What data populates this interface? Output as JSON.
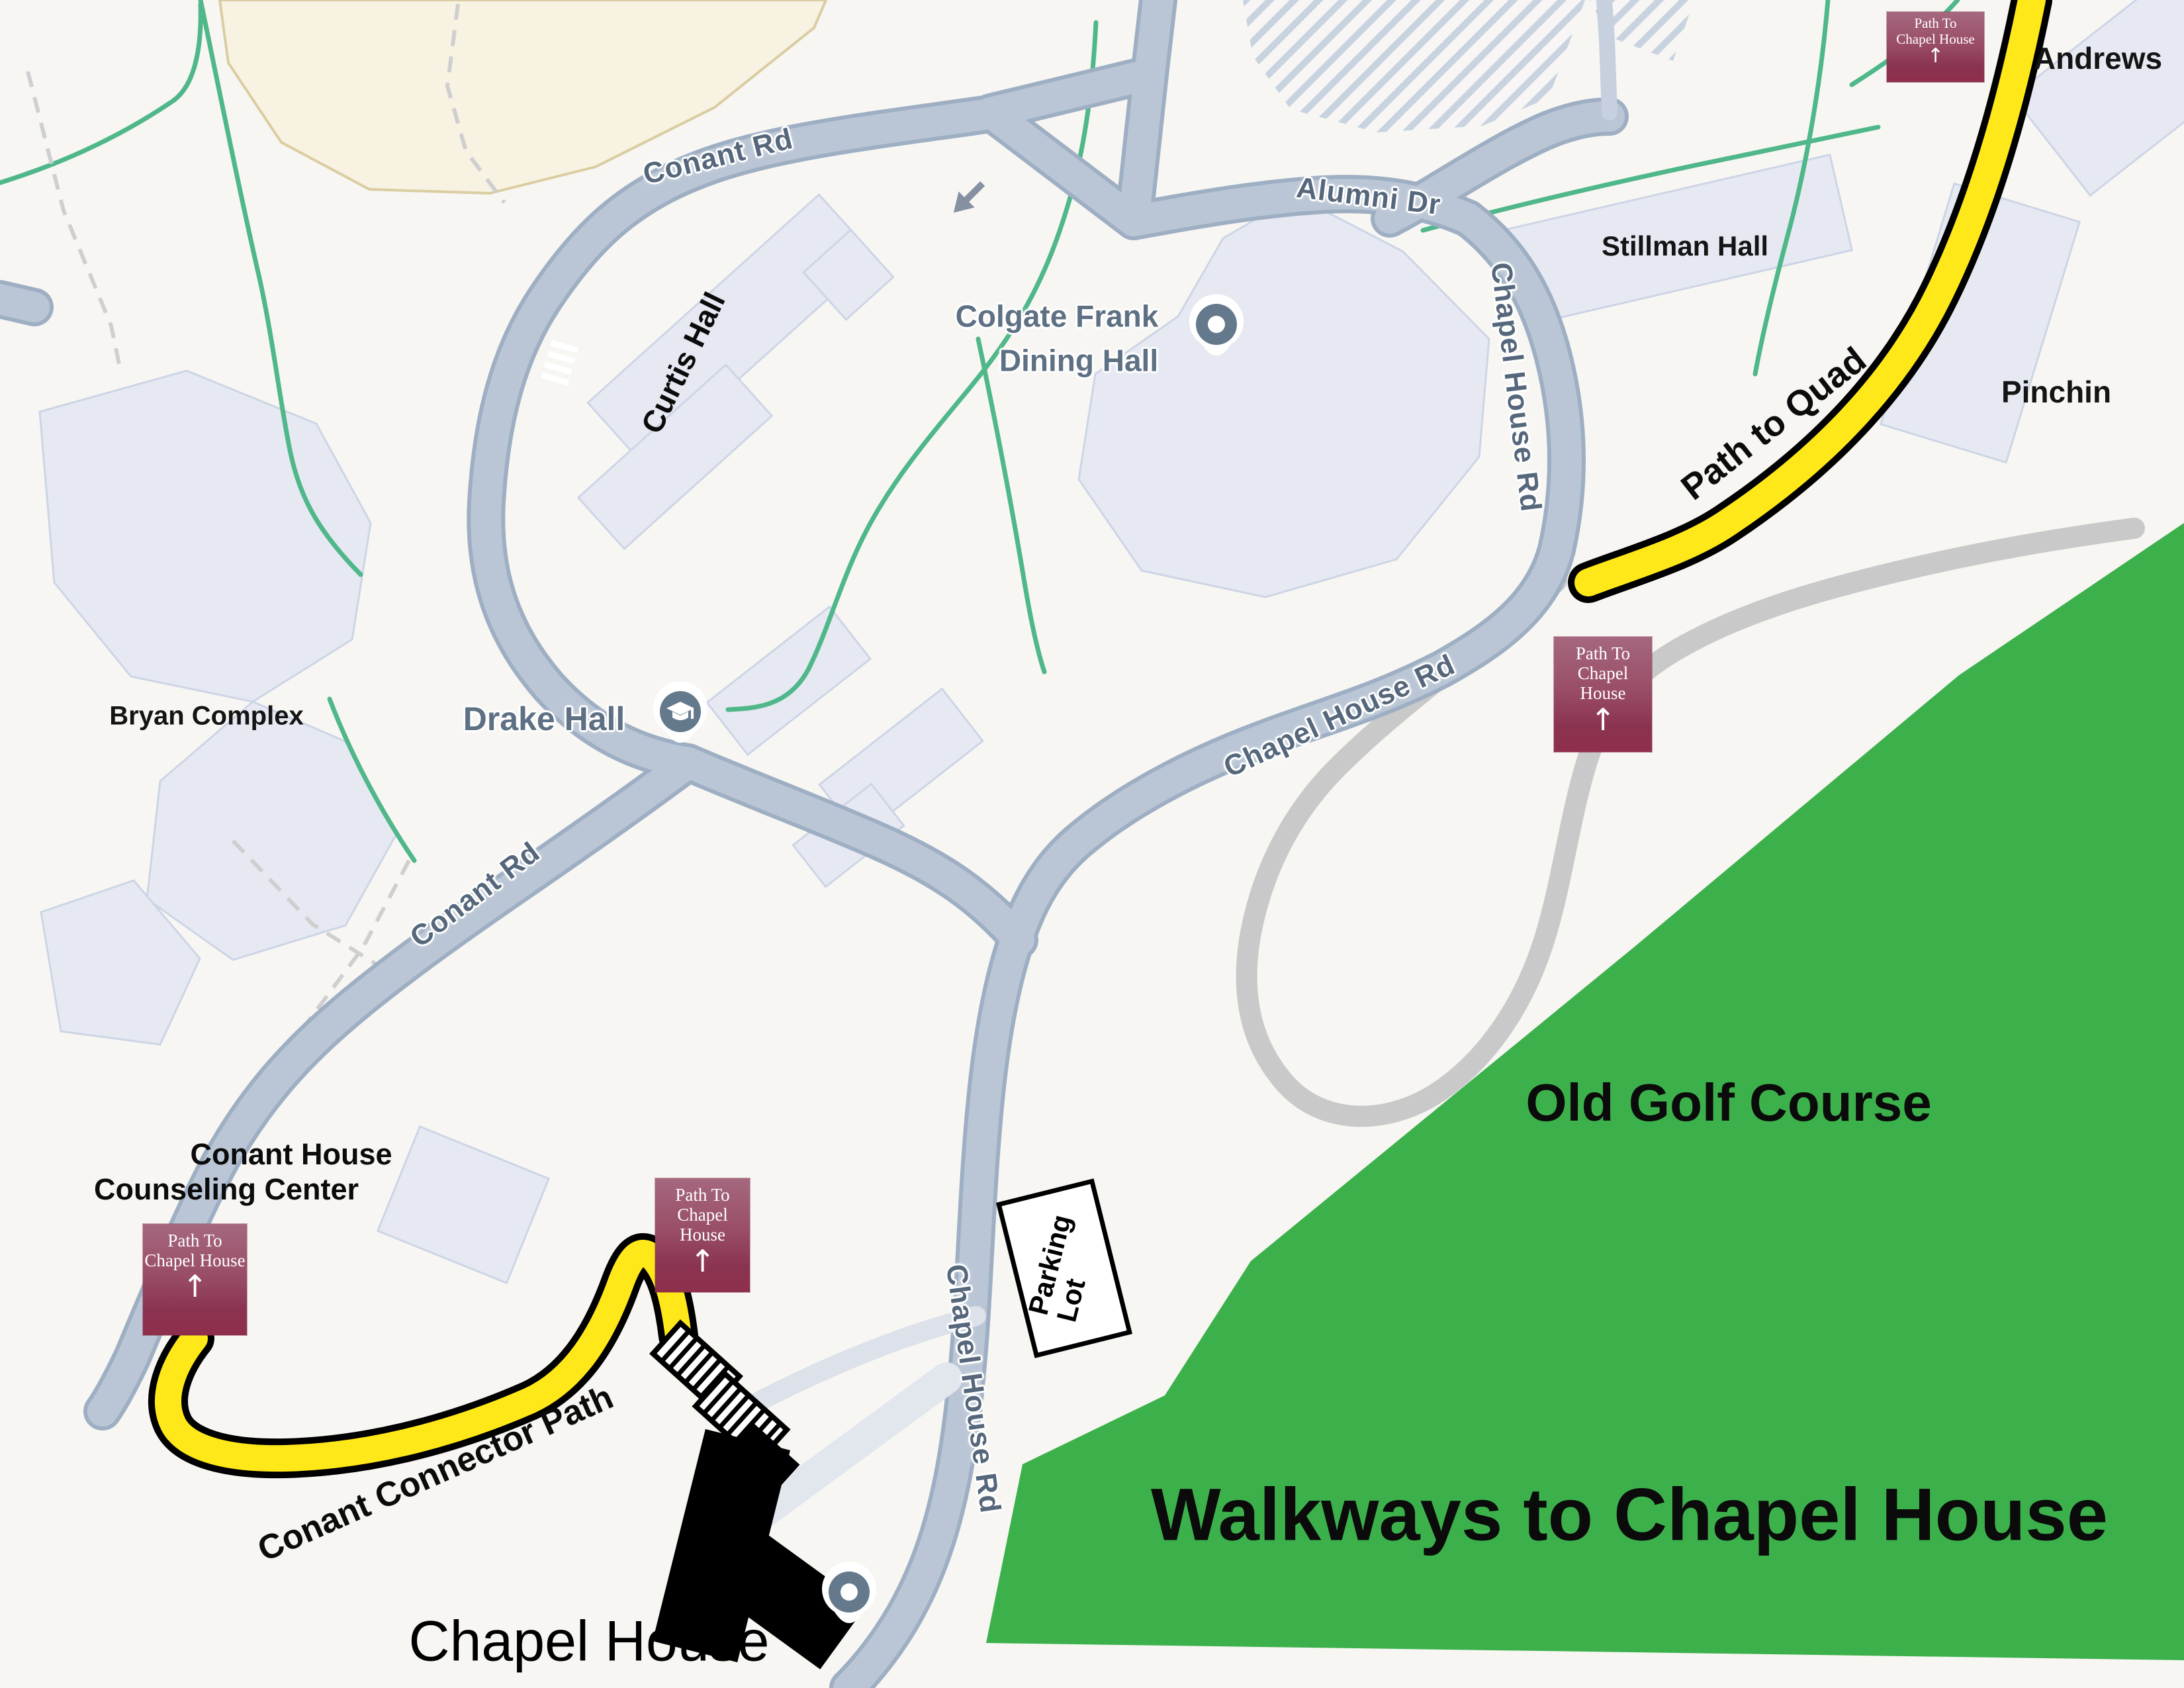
{
  "map": {
    "title": "Walkways to Chapel House",
    "area": {
      "golf_course": "Old Golf Course"
    },
    "roads": {
      "conant_rd": "Conant Rd",
      "alumni_dr": "Alumni Dr",
      "chapel_house_rd": "Chapel House Rd"
    },
    "paths": {
      "path_to_quad": "Path to Quad",
      "conant_connector": "Conant Connector Path"
    },
    "parking_sign": {
      "line1": "Parking",
      "line2": "Lot"
    },
    "buildings": {
      "andrews": "Andrews",
      "stillman": "Stillman Hall",
      "pinchin": "Pinchin",
      "curtis": "Curtis Hall",
      "bryan": "Bryan Complex",
      "drake": "Drake Hall",
      "colgate_line1": "Colgate Frank",
      "colgate_line2": "Dining Hall",
      "conant_house_line1": "Conant House",
      "conant_house_line2": "Counseling Center",
      "chapel_house": "Chapel House"
    },
    "trail_sign": {
      "line1": "Path To",
      "line2": "Chapel House",
      "arrow": "↑"
    },
    "colors": {
      "golf_green": "#3CB14B",
      "road_fill": "#BAC6D5",
      "road_casing": "#9EAFC3",
      "walkway_yellow": "#FFE819",
      "sign_maroon_top": "#A5687F",
      "sign_maroon_bottom": "#8F2F4C",
      "pin_slate": "#64798C",
      "green_path": "#50B78A",
      "gray_walkway": "#C9C9C9"
    }
  }
}
